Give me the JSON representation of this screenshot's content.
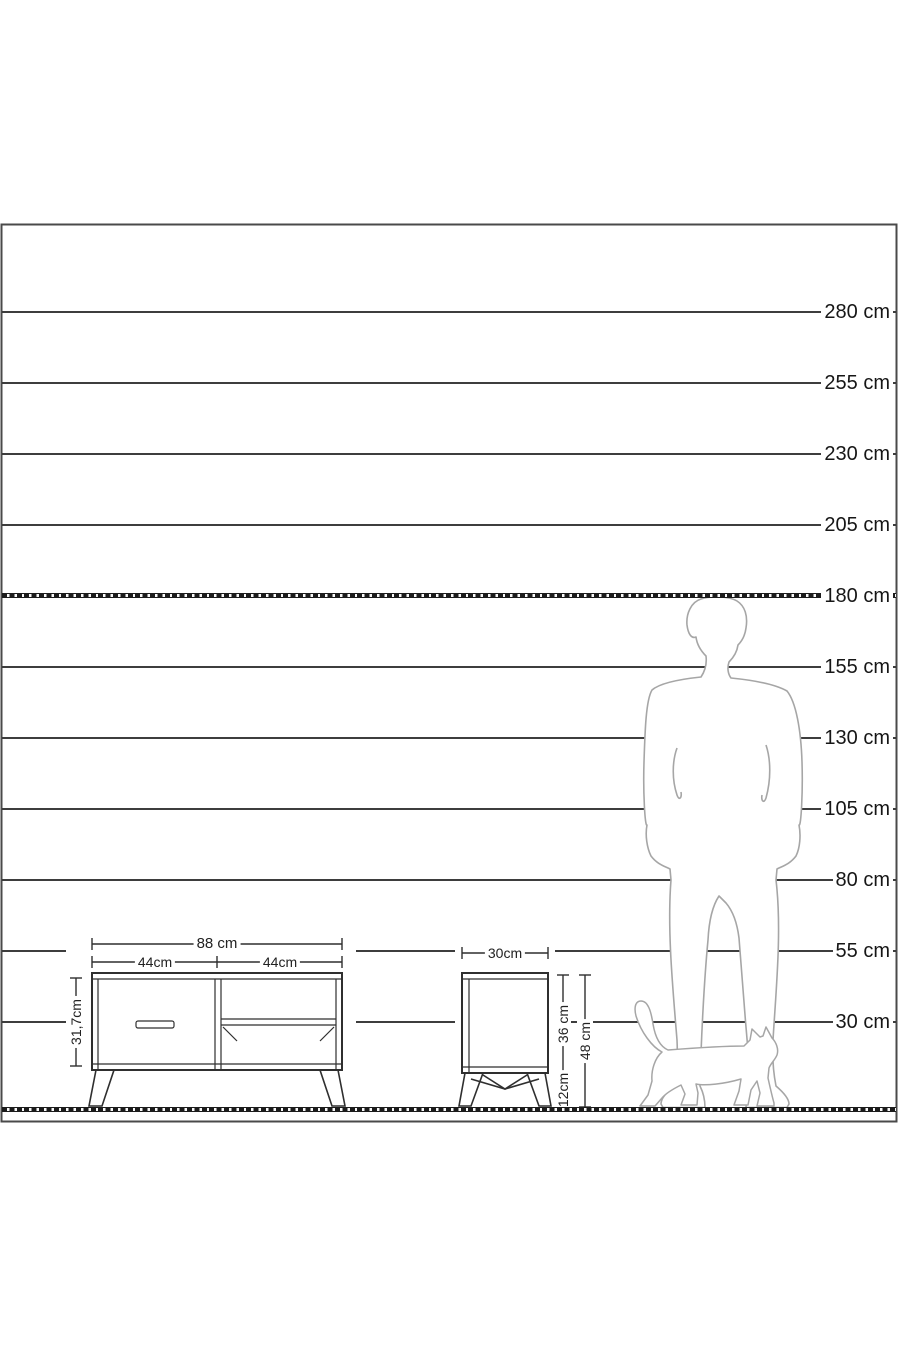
{
  "ruler": {
    "unit": "cm",
    "labels": [
      {
        "text": "280 cm",
        "value": 280
      },
      {
        "text": "255 cm",
        "value": 255
      },
      {
        "text": "230 cm",
        "value": 230
      },
      {
        "text": "205 cm",
        "value": 205
      },
      {
        "text": "180 cm",
        "value": 180
      },
      {
        "text": "155 cm",
        "value": 155
      },
      {
        "text": "130 cm",
        "value": 130
      },
      {
        "text": "105 cm",
        "value": 105
      },
      {
        "text": "80 cm",
        "value": 80
      },
      {
        "text": "55 cm",
        "value": 55
      },
      {
        "text": "30 cm",
        "value": 30
      }
    ]
  },
  "tv_stand": {
    "width_label": "88 cm",
    "half_width_left_label": "44cm",
    "half_width_right_label": "44cm",
    "height_label": "31,7cm"
  },
  "nightstand": {
    "width_label": "30cm",
    "body_height_label": "36 cm",
    "leg_height_label": "12cm",
    "total_height_label": "48 cm"
  },
  "colors": {
    "line": "#3d3d3d",
    "furniture_stroke": "#2f2f2f",
    "silhouette_stroke": "#a6a6a6",
    "hatch": "#1c1c1c",
    "background": "#ffffff"
  }
}
